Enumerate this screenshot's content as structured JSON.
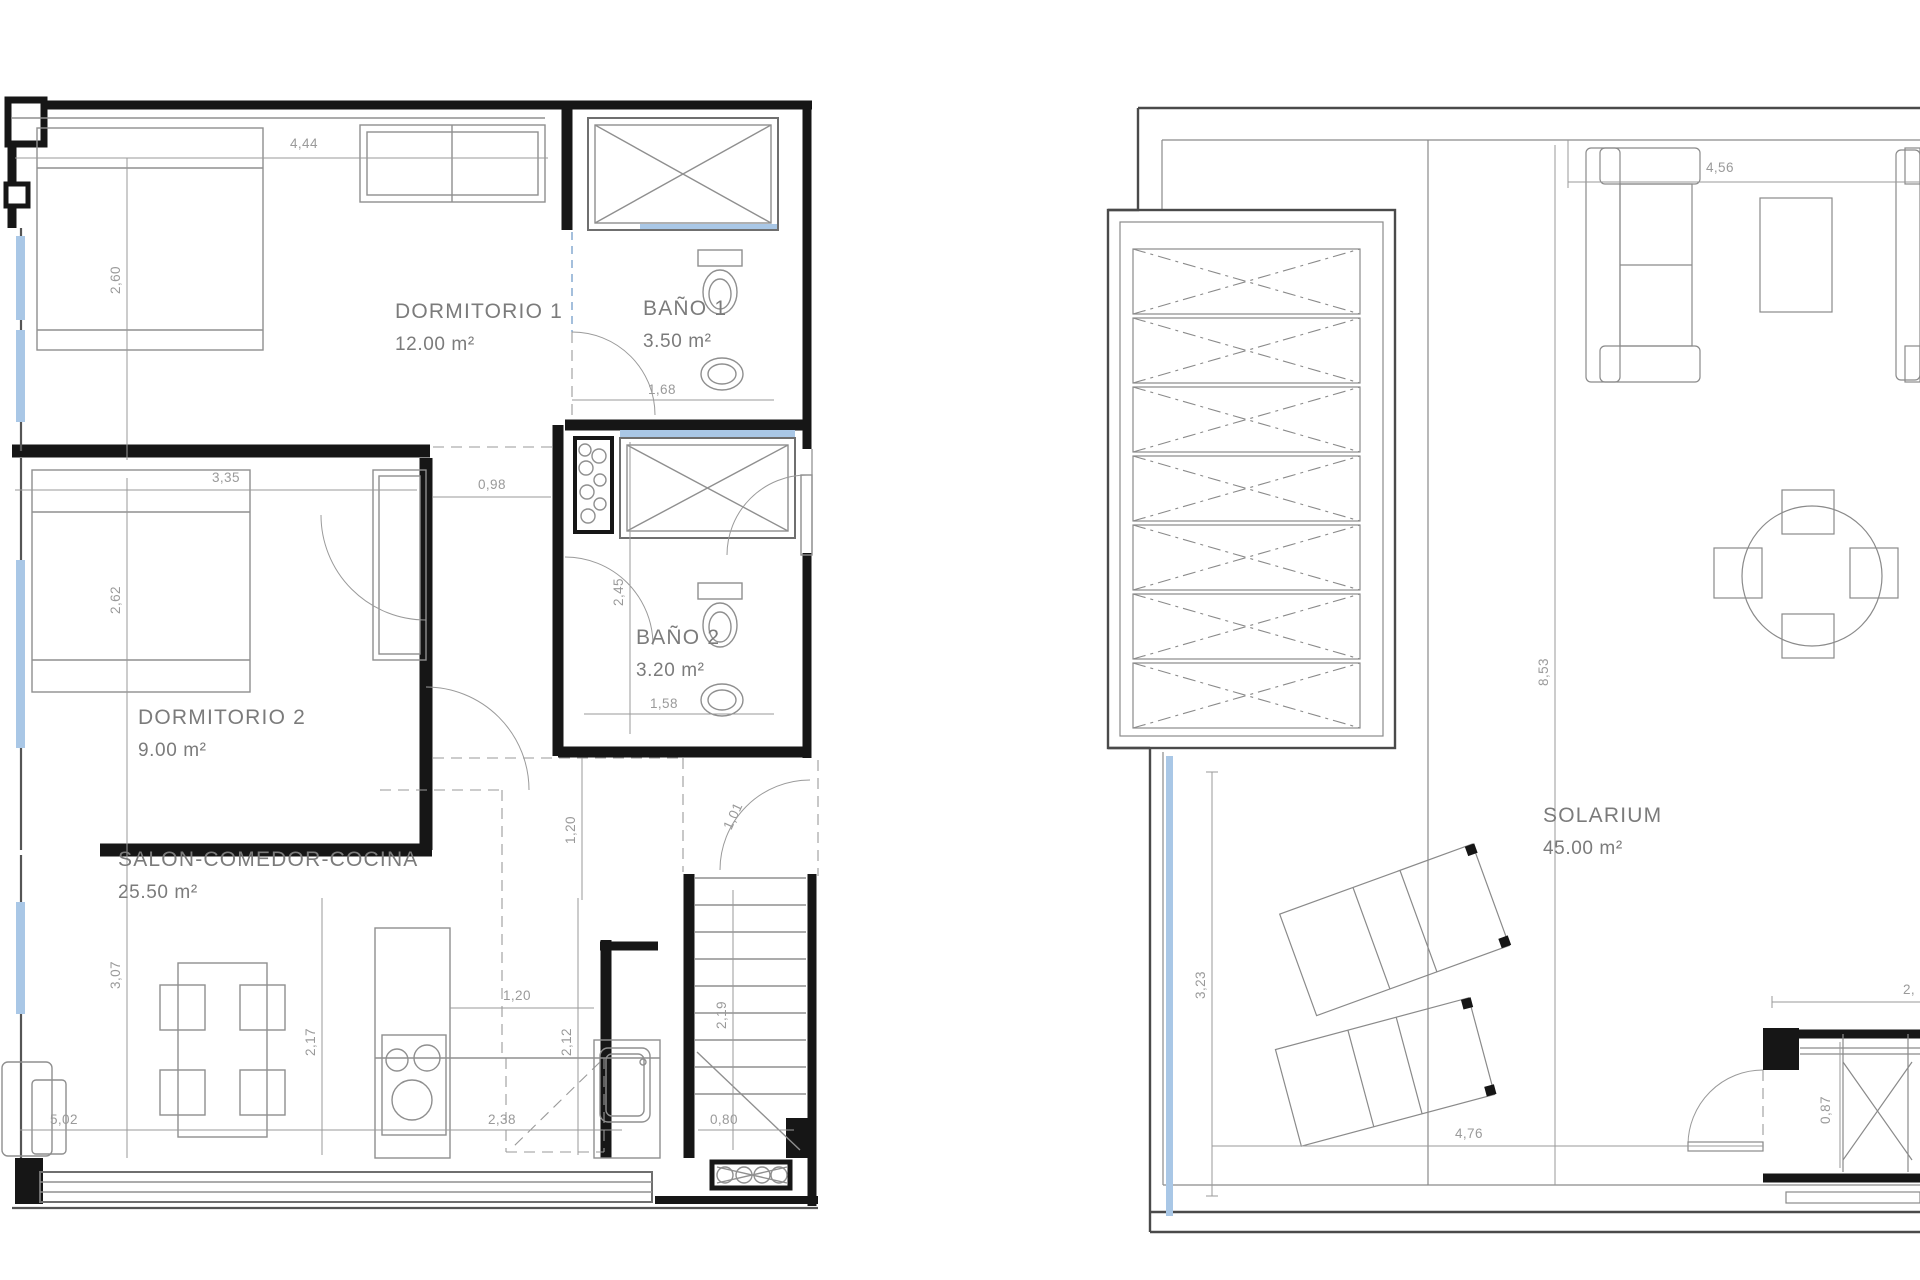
{
  "page": {
    "background": "#ffffff",
    "type": "architectural-floor-plan"
  },
  "colors": {
    "wall": "#161616",
    "furniture_line": "#8f8f8f",
    "dimension_text": "#9a9a9a",
    "room_text": "#7b7b7b",
    "window_glass": "#a9c7e6",
    "right_plan_outline": "#4a4a4a"
  },
  "plans": {
    "left": {
      "title": "apartment floor plan",
      "rooms": [
        {
          "label": "DORMITORIO 1",
          "area": "12.00 m²"
        },
        {
          "label": "BAÑO 1",
          "area": "3.50 m²"
        },
        {
          "label": "DORMITORIO 2",
          "area": "9.00 m²"
        },
        {
          "label": "BAÑO 2",
          "area": "3.20 m²"
        },
        {
          "label": "SALON-COMEDOR-COCINA",
          "area": "25.50 m²"
        }
      ],
      "dims": [
        "4,44",
        "2,60",
        "1,68",
        "3,35",
        "0,98",
        "2,62",
        "2,45",
        "1,58",
        "1,20",
        "1,01",
        "1,20",
        "3,07",
        "2,17",
        "2,12",
        "2,19",
        "5,02",
        "2,38",
        "0,80"
      ]
    },
    "right": {
      "title": "solarium roof plan",
      "rooms": [
        {
          "label": "SOLARIUM",
          "area": "45.00 m²"
        }
      ],
      "dims": [
        "4,56",
        "8,53",
        "3,23",
        "4,76",
        "0,87",
        "2,"
      ]
    }
  }
}
